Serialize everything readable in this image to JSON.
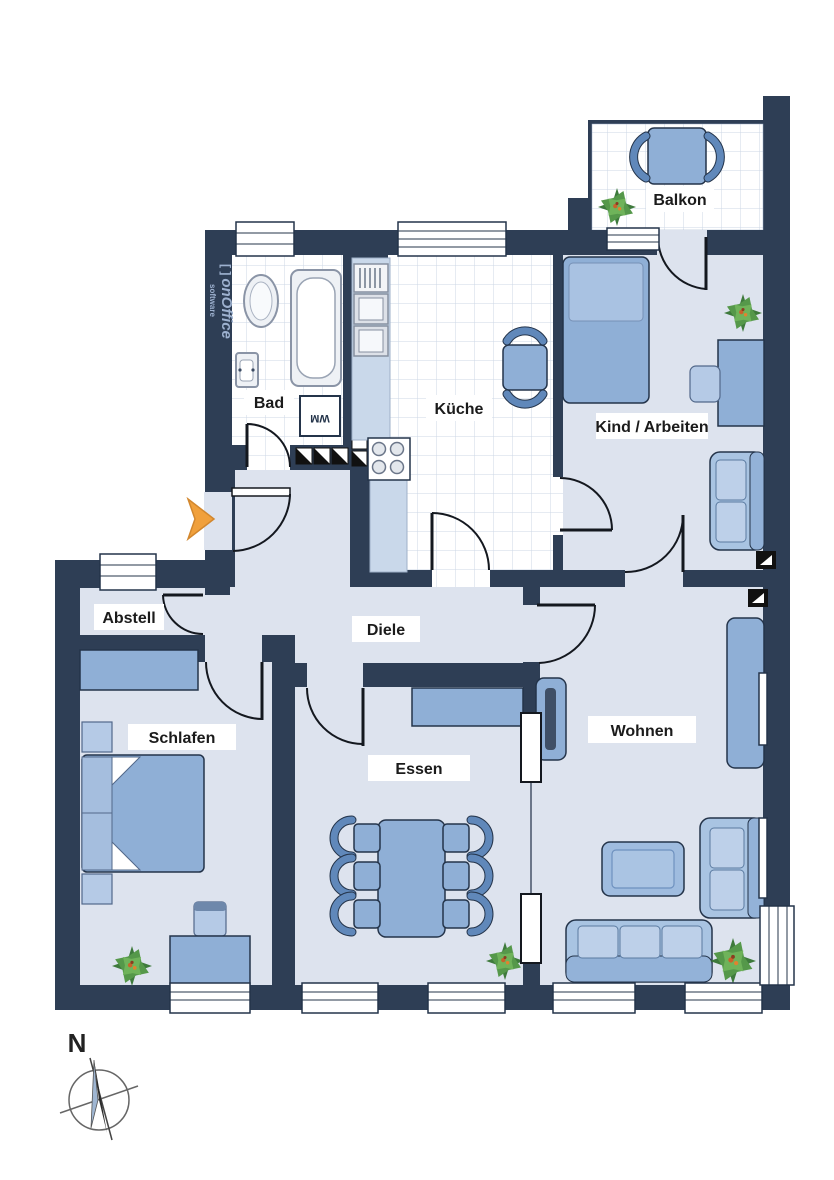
{
  "rooms": [
    {
      "id": "balkon",
      "label": "Balkon"
    },
    {
      "id": "bad",
      "label": "Bad"
    },
    {
      "id": "kueche",
      "label": "Küche"
    },
    {
      "id": "kind-arbeiten",
      "label": "Kind / Arbeiten"
    },
    {
      "id": "abstell",
      "label": "Abstell"
    },
    {
      "id": "diele",
      "label": "Diele"
    },
    {
      "id": "schlafen",
      "label": "Schlafen"
    },
    {
      "id": "essen",
      "label": "Essen"
    },
    {
      "id": "wohnen",
      "label": "Wohnen"
    }
  ],
  "appliances": {
    "washing_machine": "WM"
  },
  "compass": {
    "north": "N"
  },
  "watermark": {
    "prefix": "[ ]",
    "brand": "onOffice",
    "sub": "software"
  },
  "colors": {
    "wall": "#2e3e55",
    "floor": "#dde3ee",
    "tile_line": "#ccd7e6",
    "furniture": "#8fafd6",
    "furniture_light": "#b5cae6",
    "entrance_arrow": "#f0a03c",
    "plant_green": "#55984a",
    "label_text": "#1b1b1b"
  }
}
